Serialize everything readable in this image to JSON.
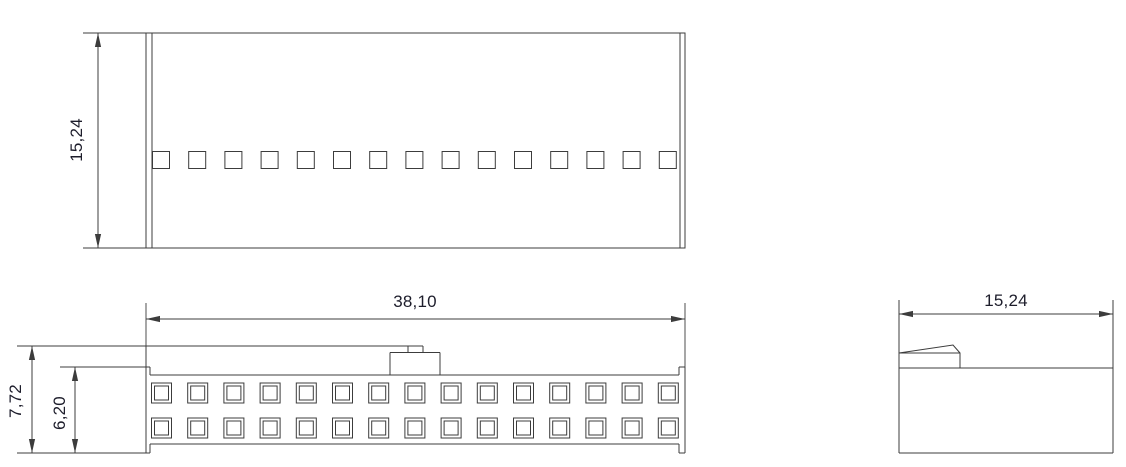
{
  "colors": {
    "background": "#ffffff",
    "lines": "#3c3c3c",
    "text": "#1d1d2b"
  },
  "views": {
    "top": {
      "slot_count": 15,
      "height_dim": "15,24"
    },
    "front": {
      "pin_columns": 15,
      "pin_rows": 2,
      "width_dim": "38,10",
      "overall_height_dim": "7,72",
      "body_height_dim": "6,20"
    },
    "side": {
      "depth_dim": "15,24"
    }
  }
}
